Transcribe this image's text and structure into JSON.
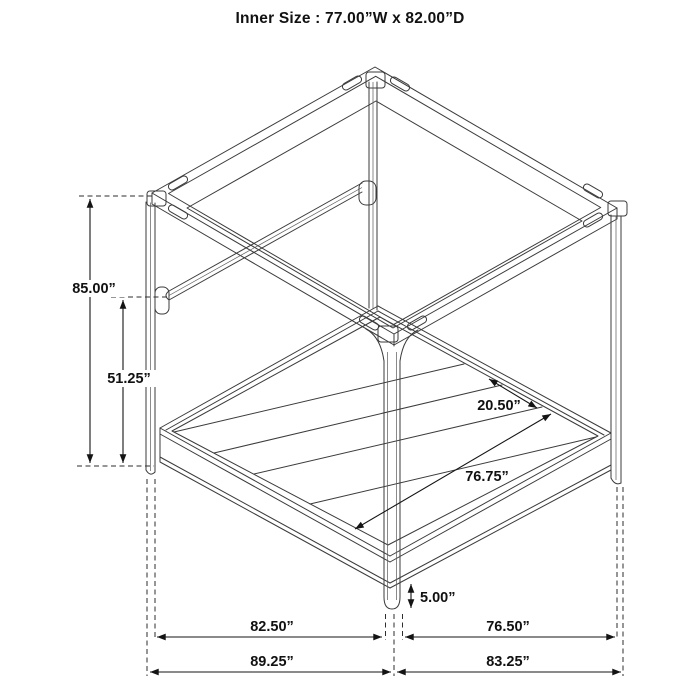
{
  "title": "Inner Size : 77.00”W x 82.00”D",
  "colors": {
    "background": "#ffffff",
    "line": "#3b3b3b",
    "dimension": "#141414",
    "text": "#111111"
  },
  "dimensions": {
    "overall_height": "85.00”",
    "upper_rail_height": "51.25”",
    "slat_spacing": "20.50”",
    "slat_length": "76.75”",
    "base_clearance": "5.00”",
    "depth_inner": "82.50”",
    "width_inner": "76.50”",
    "depth_outer": "89.25”",
    "width_outer": "83.25”"
  }
}
